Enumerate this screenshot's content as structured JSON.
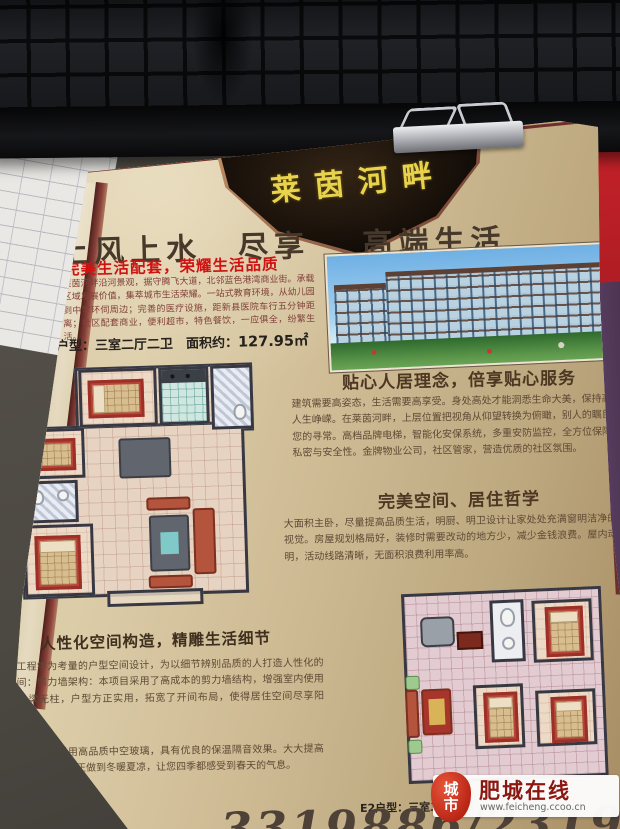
{
  "flyer": {
    "brand": "莱茵河畔",
    "slogan": "上风上水　尽享　 高端生活",
    "subhead": "完美生活配套，荣耀生活品质",
    "intro": "莱茵河畔沿河景观，据守腾飞大道，北邻蓝色港湾商业街。承载区域发展价值，集萃城市生活荣耀。一站式教育环境，从幼儿园到中学环伺周边；完善的医疗设施，距新县医院车行五分钟距离；社区配套商业，便利超市，特色餐饮，一应俱全，纷繁生活。",
    "e1_line": {
      "label": "E1户型：",
      "rooms": "三室二厅二卫",
      "gap": "　",
      "area_label": "面积约：",
      "area": "127.95㎡"
    },
    "sections": [
      {
        "title": "贴心人居理念，倍享贴心服务",
        "body": "建筑需要高姿态，生活需要高享受。身处高处才能洞悉生命大美，保持高尚方显人生峥嵘。在莱茵河畔，上层位置把视角从仰望转换为俯瞰，别人的瞩目将成为您的寻常。高档品牌电梯，智能化安保系统，多重安防监控，全方位保障居住的私密与安全性。金牌物业公司，社区管家，营造优质的社区氛围。"
      },
      {
        "title": "完美空间、居住哲学",
        "body": "大面积主卧，尽量提高品质生活，明厨、明卫设计让家处处充满窗明洁净的清新视觉。房屋规划格局好，装修时需要改动的地方少，减少金钱浪费。屋内动线分明，活动线路清晰，无面积浪费利用率高。"
      },
      {
        "title": "人性化空间构造，精雕生活细节",
        "body": "以人体工程学为考量的户型空间设计，为以细节辨别品质的人打造人性化的居家空间：剪力墙架构：本项目采用了高成本的剪力墙结构，增强室内使用面积，少梁无柱，户型方正实用，拓宽了开间布局，使得居住空间尽享阳光。",
        "body2": "环保节能：窗户采用高品质中空玻璃，具有优良的保温隔音效果。大大提高房间的保温性能，真正做到冬暖夏凉，让您四季都感受到春天的气息。"
      }
    ],
    "e2_label": "E2户型：三室二厅二卫",
    "phone": "3319886/2319777"
  },
  "watermark": {
    "badge_top": "城",
    "badge_bottom": "市",
    "site_name": "肥城在线",
    "site_url": "www.feicheng.ccoo.cn"
  },
  "colors": {
    "accent_red": "#cf1212",
    "brand_gold": "#e9d34d",
    "flyer_tan": "#cfbc95",
    "watermark_red": "#b62313"
  }
}
